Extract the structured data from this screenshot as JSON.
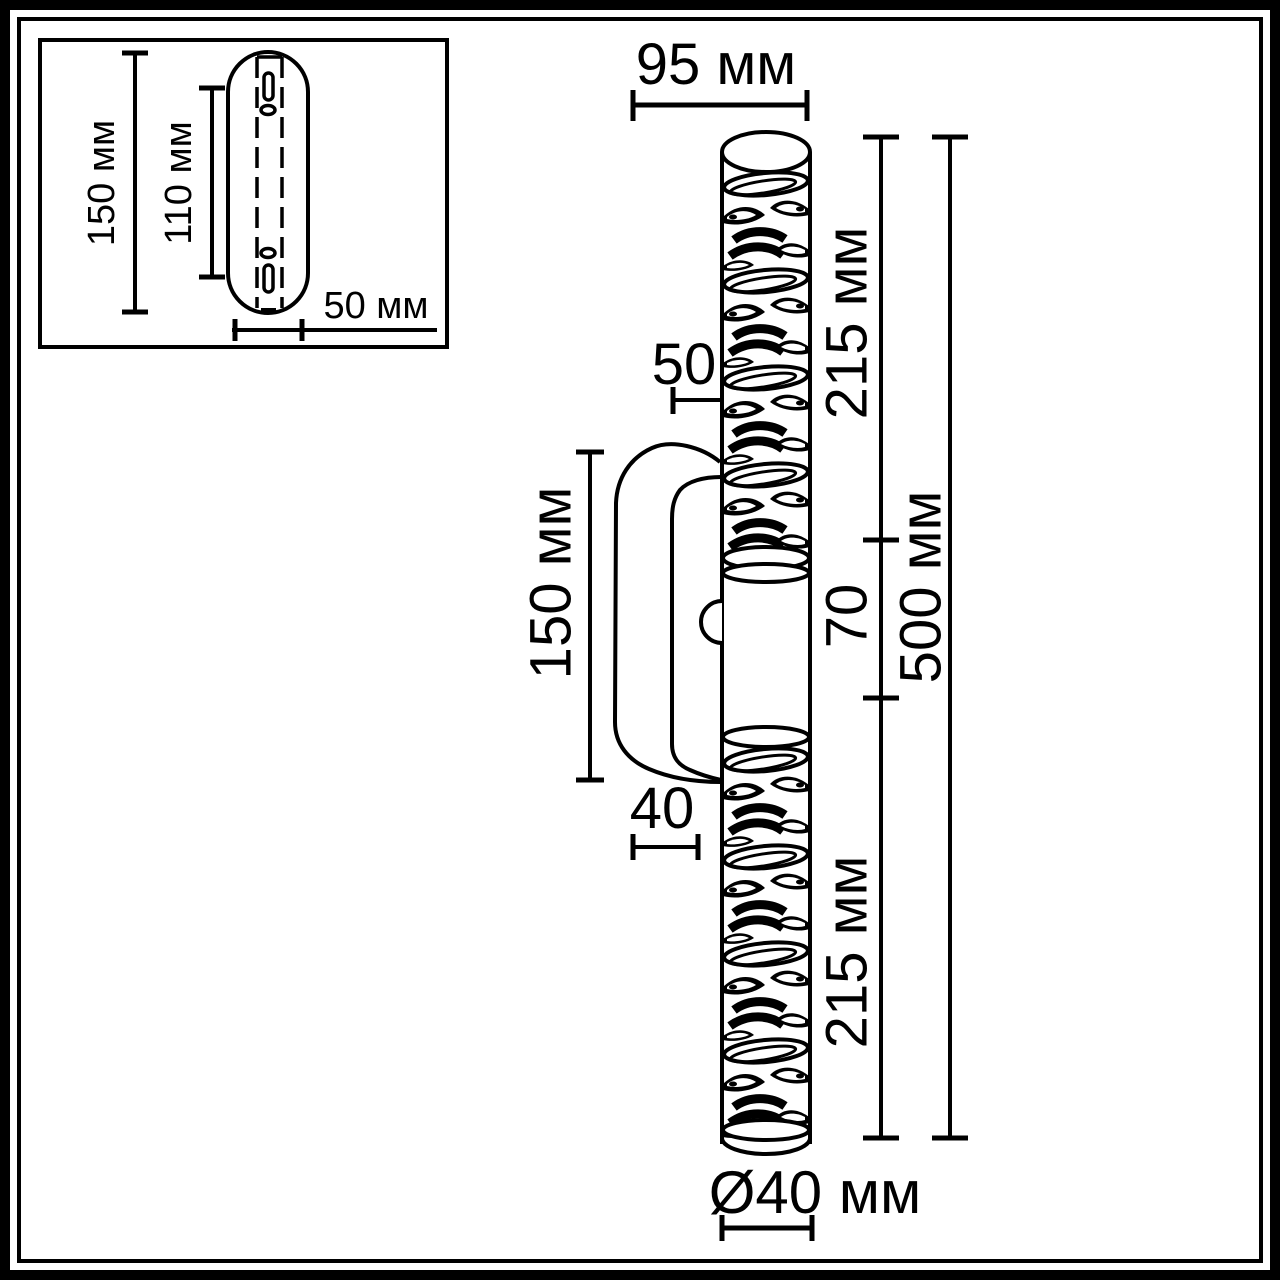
{
  "colors": {
    "ink": "#000000",
    "paper": "#ffffff"
  },
  "inset": {
    "height_label": "150 мм",
    "slot_span_label": "110 мм",
    "width_label": "50 мм"
  },
  "main": {
    "top_width_label": "95 мм",
    "wall_offset_label": "50",
    "bracket_height_label": "150 мм",
    "bracket_depth_label": "40",
    "upper_section_label": "215 мм",
    "middle_section_label": "70",
    "lower_section_label": "215 мм",
    "total_height_label": "500 мм",
    "diameter_label": "Ø40 мм"
  }
}
